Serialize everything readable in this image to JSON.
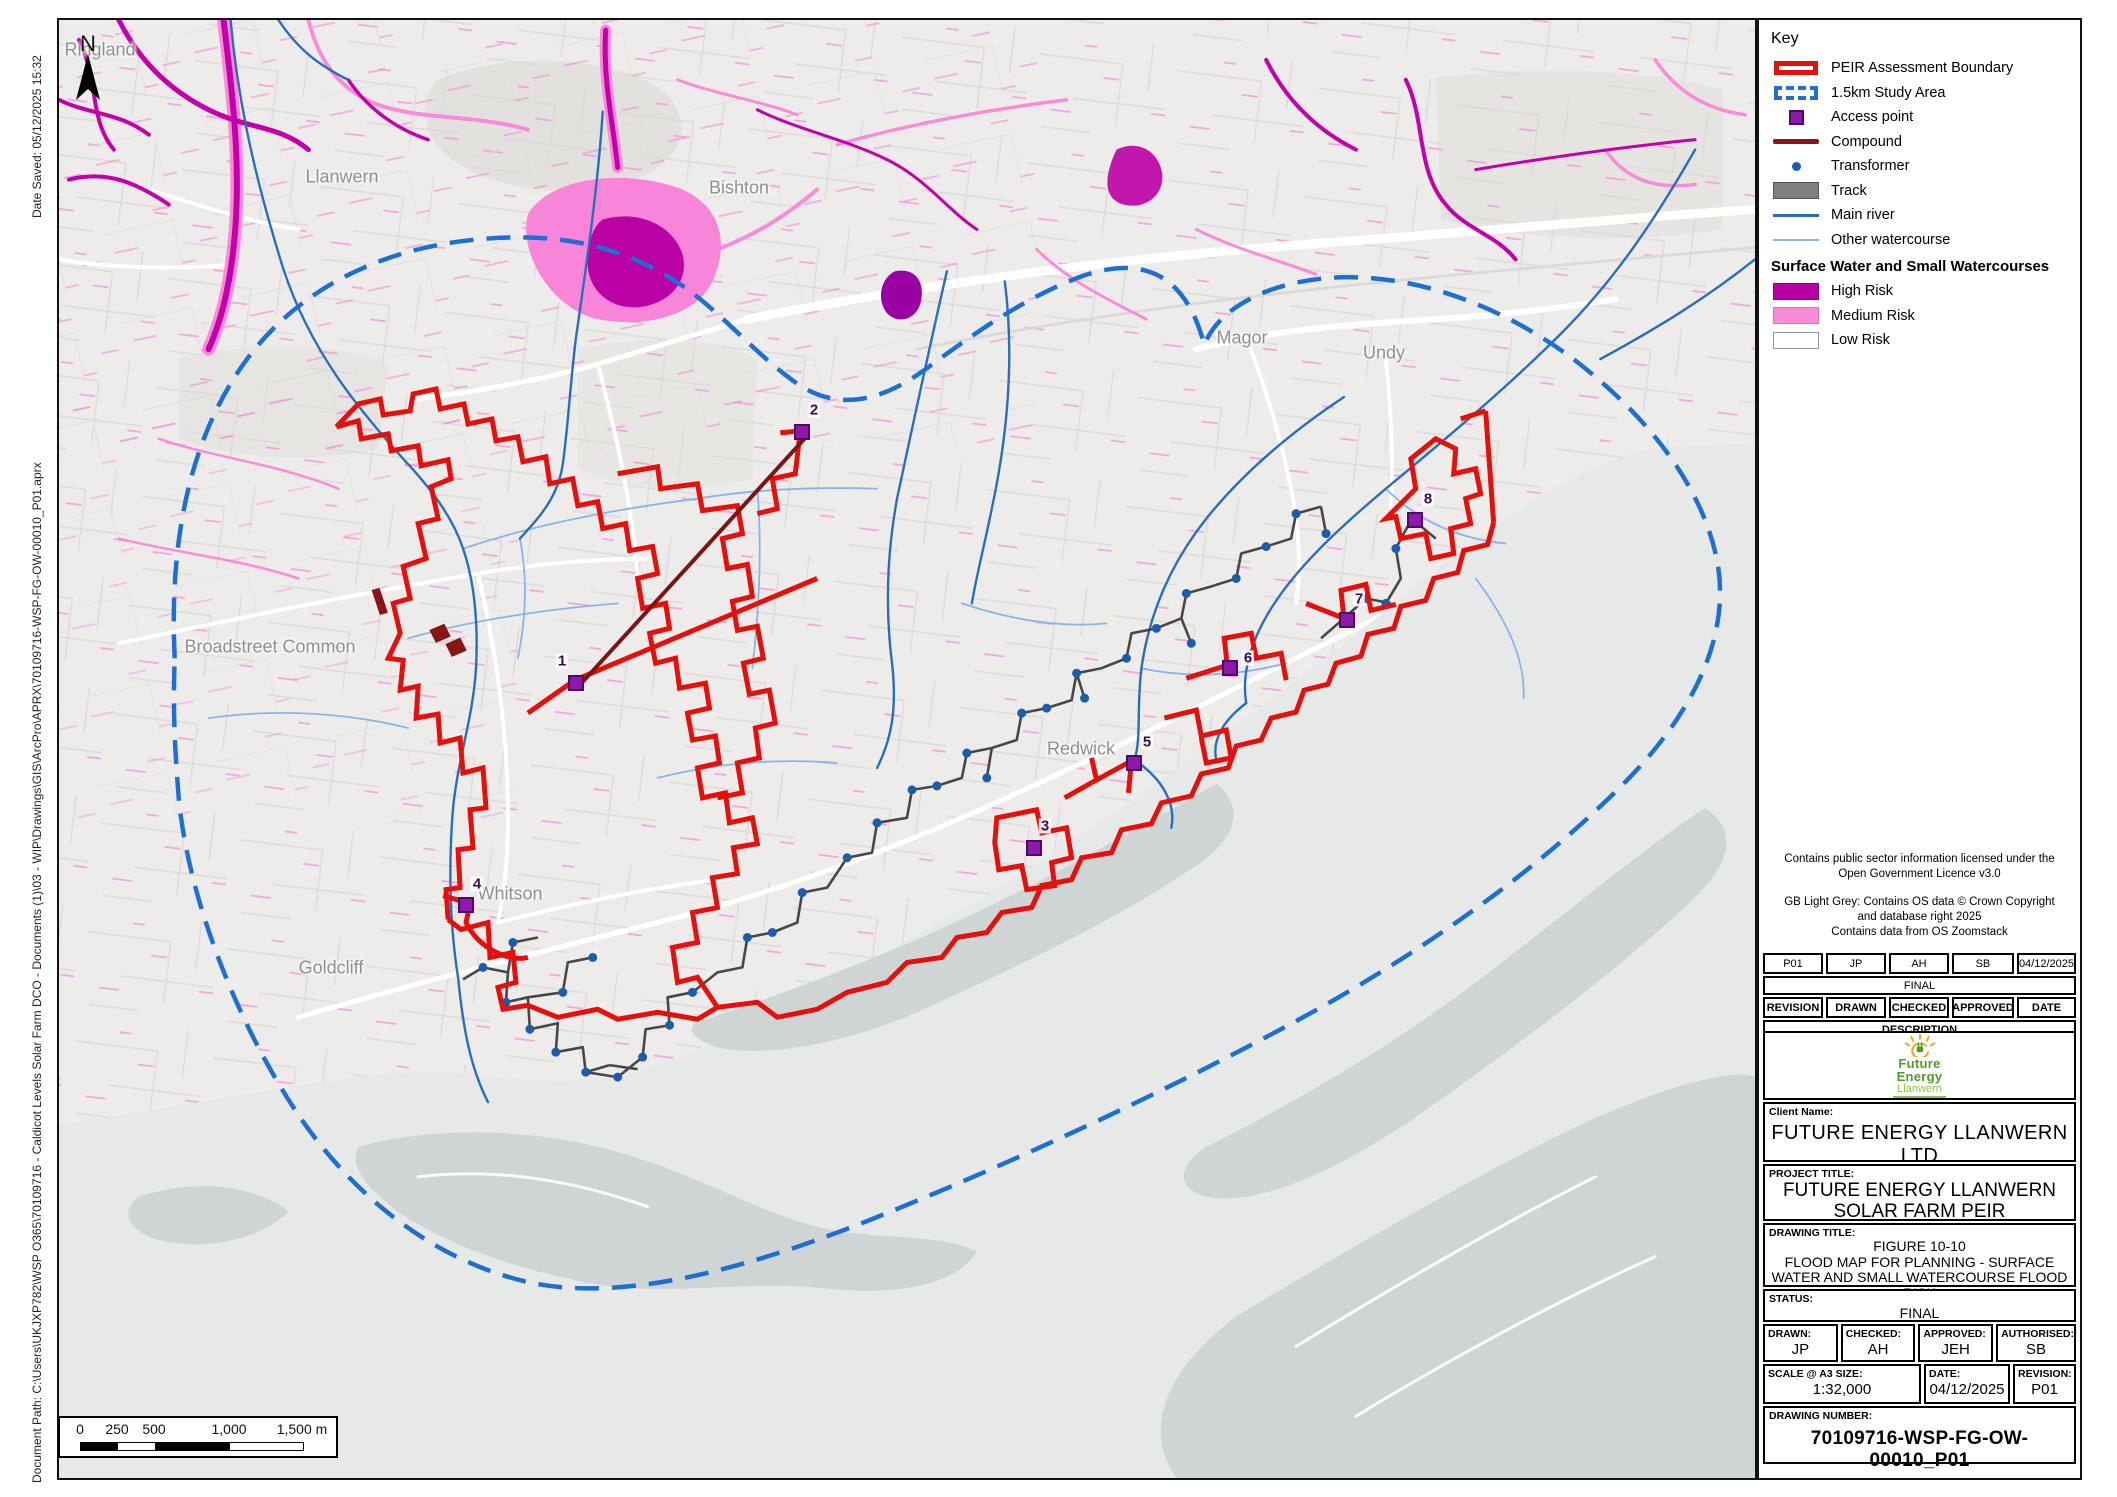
{
  "page": {
    "date_saved": "Date Saved: 05/12/2025 15:32",
    "document_path": "Document Path: C:\\Users\\UKJXP782\\WSP O365\\70109716 - Caldicot Levels Solar Farm DCO - Documents (1)\\03 - WIP\\Drawings\\GIS\\ArcPro\\APRX\\70109716-WSP-FG-OW-00010_P01.aprx"
  },
  "map": {
    "north_label": "N",
    "place_labels": [
      {
        "text": "Ringland",
        "x": 98,
        "y": 48
      },
      {
        "text": "Llanwern",
        "x": 340,
        "y": 175
      },
      {
        "text": "Bishton",
        "x": 737,
        "y": 186
      },
      {
        "text": "Magor",
        "x": 1240,
        "y": 336
      },
      {
        "text": "Undy",
        "x": 1382,
        "y": 351
      },
      {
        "text": "Broadstreet Common",
        "x": 268,
        "y": 645
      },
      {
        "text": "Redwick",
        "x": 1079,
        "y": 747
      },
      {
        "text": "Whitson",
        "x": 508,
        "y": 892
      },
      {
        "text": "Goldcliff",
        "x": 329,
        "y": 966
      }
    ],
    "access_points": [
      {
        "num": "1",
        "x": 574,
        "y": 681,
        "lx": 560,
        "ly": 659
      },
      {
        "num": "2",
        "x": 800,
        "y": 430,
        "lx": 812,
        "ly": 408
      },
      {
        "num": "3",
        "x": 1032,
        "y": 846,
        "lx": 1043,
        "ly": 824
      },
      {
        "num": "4",
        "x": 464,
        "y": 903,
        "lx": 475,
        "ly": 882
      },
      {
        "num": "5",
        "x": 1132,
        "y": 761,
        "lx": 1145,
        "ly": 740
      },
      {
        "num": "6",
        "x": 1228,
        "y": 666,
        "lx": 1246,
        "ly": 656
      },
      {
        "num": "7",
        "x": 1345,
        "y": 618,
        "lx": 1357,
        "ly": 597
      },
      {
        "num": "8",
        "x": 1413,
        "y": 518,
        "lx": 1426,
        "ly": 497
      }
    ],
    "scale_bar": {
      "labels": [
        "0",
        "250",
        "500",
        "1,000",
        "1,500 m"
      ]
    }
  },
  "key": {
    "title": "Key",
    "items": [
      {
        "label": "PEIR Assessment Boundary"
      },
      {
        "label": "1.5km Study Area"
      },
      {
        "label": "Access point"
      },
      {
        "label": "Compound"
      },
      {
        "label": "Transformer"
      },
      {
        "label": "Track"
      },
      {
        "label": "Main river"
      },
      {
        "label": "Other watercourse"
      }
    ],
    "subheader": "Surface Water and Small Watercourses",
    "risk_items": [
      {
        "label": "High Risk"
      },
      {
        "label": "Medium Risk"
      },
      {
        "label": "Low Risk"
      }
    ],
    "colors": {
      "boundary_red": "#e50f0c",
      "study_blue": "#1e6fd2",
      "access_purple": "#8d18ab",
      "compound_dark_red": "#8b1414",
      "transformer_blue": "#1b5cad",
      "track_grey": "#7f7f7f",
      "main_river": "#2a6ebb",
      "other_watercourse": "#8ab4e8",
      "high_risk": "#b800a4",
      "medium_risk": "#fa8bd9",
      "low_risk": "#ffffff"
    }
  },
  "notes": {
    "lines": [
      "Contains public sector information licensed under the",
      "Open Government Licence v3.0",
      "GB Light Grey: Contains OS data © Crown Copyright",
      "and database right 2025",
      "Contains data from OS Zoomstack"
    ]
  },
  "revision_table": {
    "current": {
      "revision": "P01",
      "drawn": "JP",
      "checked": "AH",
      "approved": "SB",
      "date": "04/12/2025"
    },
    "description_value": "FINAL",
    "headers": [
      "REVISION",
      "DRAWN",
      "CHECKED",
      "APPROVED",
      "DATE"
    ],
    "description_label": "DESCRIPTION"
  },
  "logo": {
    "line1": "Future",
    "line2": "Energy",
    "line3": "Llanwern"
  },
  "title_block": {
    "client_label": "Client Name:",
    "client": "FUTURE ENERGY LLANWERN LTD",
    "project_label": "PROJECT TITLE:",
    "project_line1": "FUTURE ENERGY LLANWERN",
    "project_line2": "SOLAR FARM PEIR",
    "drawing_label": "DRAWING TITLE:",
    "drawing_line1": "FIGURE 10-10",
    "drawing_line2": "FLOOD MAP FOR PLANNING - SURFACE",
    "drawing_line3": "WATER AND SMALL WATERCOURSE FLOOD RISK",
    "status_label": "STATUS:",
    "status": "FINAL",
    "drawn_label": "DRAWN:",
    "drawn": "JP",
    "checked_label": "CHECKED:",
    "checked": "AH",
    "approved_label": "APPROVED:",
    "approved": "JEH",
    "authorised_label": "AUTHORISED:",
    "authorised": "SB",
    "scale_label": "SCALE @ A3 SIZE:",
    "scale": "1:32,000",
    "date_label": "DATE:",
    "date": "04/12/2025",
    "revision_label": "REVISION:",
    "revision": "P01",
    "number_label": "DRAWING NUMBER:",
    "number": "70109716-WSP-FG-OW-00010_P01"
  }
}
